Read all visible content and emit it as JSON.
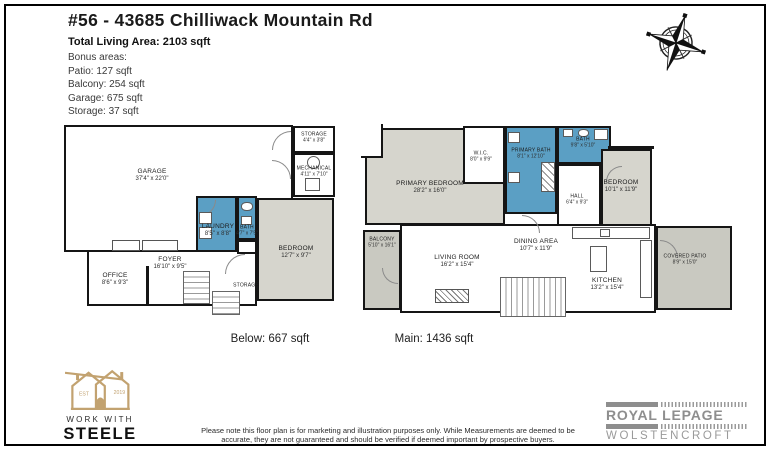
{
  "header": {
    "title": "#56 - 43685 Chilliwack Mountain Rd",
    "total_living_area": "Total Living Area: 2103 sqft",
    "bonus_lines": {
      "0": "Bonus areas:",
      "1": "Patio: 127 sqft",
      "2": "Balcony: 254 sqft",
      "3": "Garage: 675 sqft",
      "4": "Storage: 37 sqft"
    }
  },
  "plans": {
    "below": {
      "caption": "Below: 667 sqft",
      "rooms": {
        "garage": {
          "name": "GARAGE",
          "dims": "37'4\" x 22'0\""
        },
        "storage_top": {
          "name": "STORAGE",
          "dims": "4'4\" x 3'8\""
        },
        "mechanical": {
          "name": "MECHANICAL",
          "dims": "4'11\" x 7'10\""
        },
        "laundry": {
          "name": "LAUNDRY",
          "dims": "8'5\" x 8'8\""
        },
        "bath": {
          "name": "BATH",
          "dims": "4'7\" x 7'5\""
        },
        "bedroom": {
          "name": "BEDROOM",
          "dims": "12'7\" x 9'7\""
        },
        "foyer": {
          "name": "FOYER",
          "dims": "16'10\" x 9'5\""
        },
        "office": {
          "name": "OFFICE",
          "dims": "8'6\" x 9'3\""
        },
        "storage_under_stairs": {
          "name": "STORAGE",
          "dims": ""
        }
      }
    },
    "main": {
      "caption": "Main: 1436 sqft",
      "rooms": {
        "primary_bedroom": {
          "name": "PRIMARY BEDROOM",
          "dims": "28'2\" x 16'0\""
        },
        "wic": {
          "name": "W.I.C.",
          "dims": "8'0\" x 9'9\""
        },
        "primary_bath": {
          "name": "PRIMARY BATH",
          "dims": "8'1\" x 12'10\""
        },
        "bath": {
          "name": "BATH",
          "dims": "9'8\" x 5'10\""
        },
        "bedroom": {
          "name": "BEDROOM",
          "dims": "10'1\" x 11'9\""
        },
        "hall": {
          "name": "HALL",
          "dims": "6'4\" x 9'3\""
        },
        "balcony": {
          "name": "BALCONY",
          "dims": "5'10\" x 16'1\""
        },
        "living_room": {
          "name": "LIVING ROOM",
          "dims": "16'2\" x 15'4\""
        },
        "dining_area": {
          "name": "DINING AREA",
          "dims": "10'7\" x 11'9\""
        },
        "kitchen": {
          "name": "KITCHEN",
          "dims": "13'2\" x 15'4\""
        },
        "covered_patio": {
          "name": "COVERED PATIO",
          "dims": "8'9\" x 15'0\""
        }
      }
    }
  },
  "footer": {
    "steele": {
      "est": "EST",
      "year": "2019",
      "line1": "WORK WITH",
      "line2": "STEELE"
    },
    "disclaimer": "Please note this floor plan is for marketing and illustration purposes only. While Measurements are deemed to be accurate, they are not guaranteed and should be verified if deemed important by prospective buyers.",
    "royal_lepage": {
      "brand": "ROYAL LEPAGE",
      "office": "WOLSTENCROFT"
    }
  },
  "colors": {
    "room_blue": "#5B9FC4",
    "room_gray": "#D6D5CD",
    "outdoor_gray": "#C9C9C1",
    "wall_black": "#151515",
    "steele_gold": "#C2A270",
    "lepage_gray": "#8E8E8E"
  }
}
